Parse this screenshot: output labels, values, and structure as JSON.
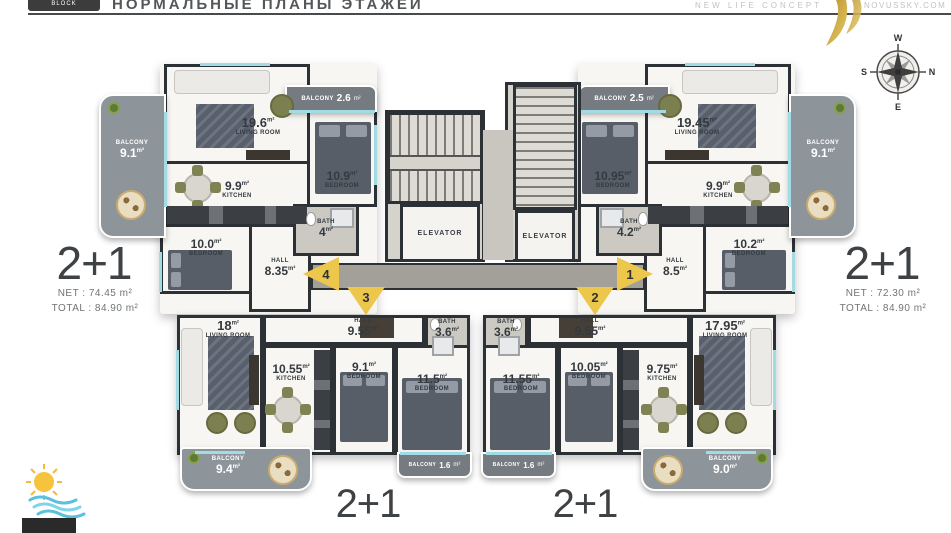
{
  "ui": {
    "m2": "m²"
  },
  "header": {
    "badge": "BLOCK",
    "title": "НОРМАЛЬНЫЕ ПЛАНЫ ЭТАЖЕЙ",
    "brand": "NEW LIFE CONCEPT",
    "website": "NOVUSSKY.COM"
  },
  "compass": {
    "top": "W",
    "right": "N",
    "bottom": "E",
    "left": "S"
  },
  "core": {
    "elevator_left": "ELEVATOR",
    "elevator_right": "ELEVATOR"
  },
  "markers": {
    "m1": "1",
    "m2": "2",
    "m3": "3",
    "m4": "4"
  },
  "summary_left": {
    "type": "2+1",
    "net": "NET : 74.45 m²",
    "total": "TOTAL : 84.90 m²"
  },
  "summary_right": {
    "type": "2+1",
    "net": "NET : 72.30 m²",
    "total": "TOTAL : 84.90 m²"
  },
  "summary_bottom_left": {
    "type": "2+1"
  },
  "summary_bottom_right": {
    "type": "2+1"
  },
  "unit_tl": {
    "living_num": "19.6",
    "living_name": "LIVING ROOM",
    "balcony_top_name": "BALCONY",
    "balcony_top_num": "2.6",
    "bed1_num": "10.9",
    "bed1_name": "BEDROOM",
    "kitchen_num": "9.9",
    "kitchen_name": "KITCHEN",
    "bed2_num": "10.0",
    "bed2_name": "BEDROOM",
    "hall_name": "HALL",
    "hall_num": "8.35",
    "bath_name": "BATH",
    "bath_num": "4",
    "balcony_side_name": "BALCONY",
    "balcony_side_num": "9.1"
  },
  "unit_tr": {
    "living_num": "19.45",
    "living_name": "LIVING ROOM",
    "balcony_top_name": "BALCONY",
    "balcony_top_num": "2.5",
    "bed1_num": "10.95",
    "bed1_name": "BEDROOM",
    "kitchen_num": "9.9",
    "kitchen_name": "KITCHEN",
    "bed2_num": "10.2",
    "bed2_name": "BEDROOM",
    "hall_name": "HALL",
    "hall_num": "8.5",
    "bath_name": "BATH",
    "bath_num": "4.2",
    "balcony_side_name": "BALCONY",
    "balcony_side_num": "9.1"
  },
  "unit_bl": {
    "living_num": "18",
    "living_name": "LIVING ROOM",
    "kitchen_num": "10.55",
    "kitchen_name": "KITCHEN",
    "bed1_num": "9.1",
    "bed1_name": "BEDROOM",
    "bed2_num": "11.5",
    "bed2_name": "BEDROOM",
    "hall_name": "HALL",
    "hall_num": "9.55",
    "bath_name": "BATH",
    "bath_num": "3.6",
    "balcony_main_name": "BALCONY",
    "balcony_main_num": "9.4",
    "balcony_small_name": "BALCONY",
    "balcony_small_num": "1.6"
  },
  "unit_br": {
    "living_num": "17.95",
    "living_name": "LIVING ROOM",
    "kitchen_num": "9.75",
    "kitchen_name": "KITCHEN",
    "bed1_num": "10.05",
    "bed1_name": "BEDROOM",
    "bed2_num": "11.55",
    "bed2_name": "BEDROOM",
    "hall_name": "HALL",
    "hall_num": "9.55",
    "bath_name": "BATH",
    "bath_num": "3.6",
    "balcony_main_name": "BALCONY",
    "balcony_main_num": "9.0",
    "balcony_small_name": "BALCONY",
    "balcony_small_num": "1.6"
  },
  "colors": {
    "wall": "#2c3136",
    "balcony": "#8e959a",
    "corridor": "#a3a09a",
    "marker_yellow": "#ecc74b",
    "gold": "#c9a338",
    "window_teal": "#a3dbe4"
  }
}
